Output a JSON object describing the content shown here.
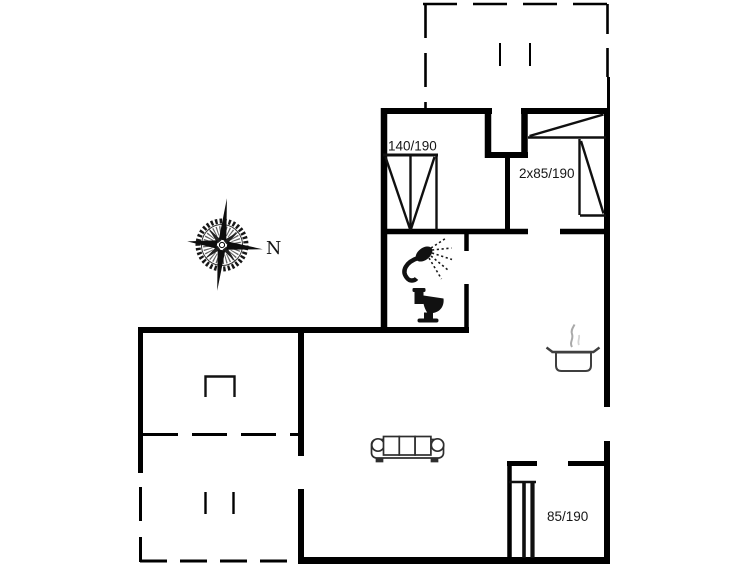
{
  "page": {
    "background_color": "#ffffff",
    "type": "holiday-home floor plan drawing"
  },
  "floorplan": {
    "wall_color": "#000000",
    "furniture_color": "#2e2e2e",
    "steam_color": "#9a9a9a",
    "labels": {
      "bedroom1_bed_size": "140/190",
      "bedroom2_bed_size": "2x85/190",
      "bedroom3_bed_size": "85/190",
      "compass_north": "N"
    },
    "icons": [
      "compass-rose-icon",
      "wood-stove-icon",
      "sofa-icon",
      "shower-icon",
      "toilet-icon",
      "cooking-pot-icon",
      "double-bed-icon",
      "twin-beds-icon",
      "single-bed-icon"
    ]
  }
}
